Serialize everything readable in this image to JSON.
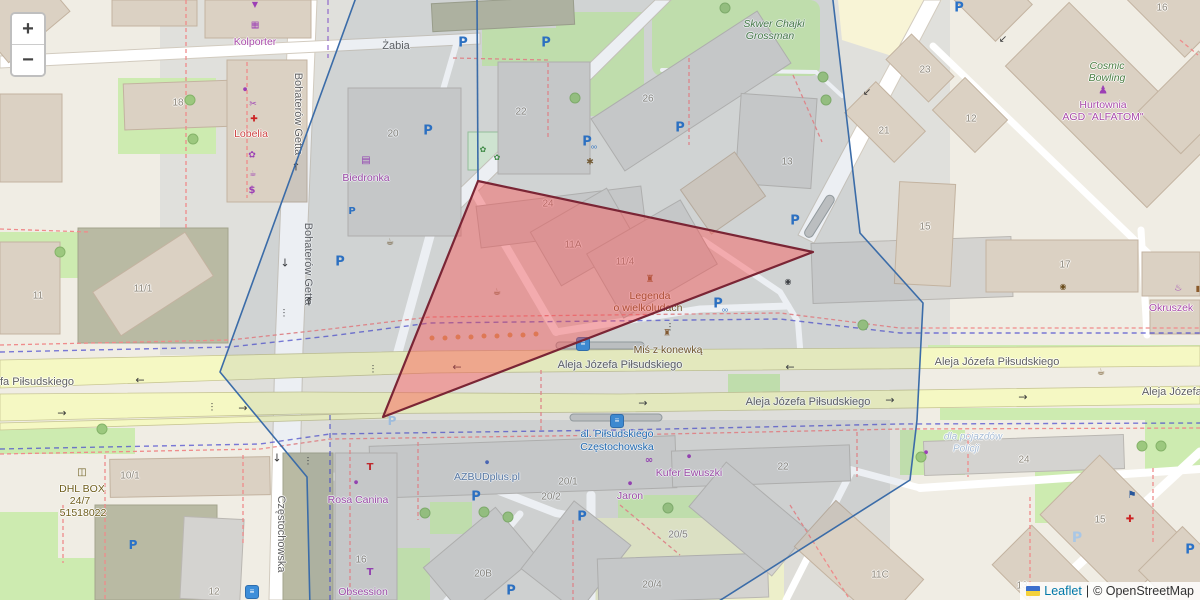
{
  "controls": {
    "zoom_in": "+",
    "zoom_out": "−"
  },
  "attribution": {
    "flag": "ukraine-flag",
    "leaflet_link": "Leaflet",
    "separator": "|",
    "copyright": "© OpenStreetMap"
  },
  "overlays": {
    "red_polygon": {
      "points": "478,181 813,252 383,417",
      "fill": "rgba(255,70,70,0.4)",
      "stroke": "#7a2535"
    },
    "blue_polygon": {
      "points": "358,-8 832,-8 860,233 923,303 917,420 910,480 708,608 310,608 307,477 220,372",
      "fill": "rgba(70,100,140,0.10)",
      "stroke": "#3b6ca8"
    },
    "blue_segment": {
      "points": "477,-5 478,181",
      "stroke": "#3b6ca8"
    }
  },
  "labels": [
    {
      "t": "Żabia",
      "x": 396,
      "y": 46,
      "c": "st"
    },
    {
      "t": "Bohaterów Getta",
      "x": 298,
      "y": 114,
      "c": "st",
      "r": 90
    },
    {
      "t": "Bohaterów Getta",
      "x": 308,
      "y": 264,
      "c": "st",
      "r": 90
    },
    {
      "t": "Częstochowska",
      "x": 281,
      "y": 534,
      "c": "st",
      "r": 90
    },
    {
      "t": "Aleja Józefa Piłsudskiego",
      "x": 620,
      "y": 365,
      "c": "st"
    },
    {
      "t": "Aleja Józefa Piłsudskiego",
      "x": 997,
      "y": 362,
      "c": "st"
    },
    {
      "t": "Aleja Józefa Piłsudskiego",
      "x": 808,
      "y": 402,
      "c": "st"
    },
    {
      "t": "fa Piłsudskiego",
      "x": 37,
      "y": 382,
      "c": "st"
    },
    {
      "t": "Aleja Józefa P",
      "x": 1177,
      "y": 392,
      "c": "st"
    },
    {
      "t": "18",
      "x": 178,
      "y": 103,
      "c": "num"
    },
    {
      "t": "20",
      "x": 393,
      "y": 134,
      "c": "num"
    },
    {
      "t": "22",
      "x": 521,
      "y": 112,
      "c": "num"
    },
    {
      "t": "26",
      "x": 648,
      "y": 99,
      "c": "num"
    },
    {
      "t": "13",
      "x": 787,
      "y": 162,
      "c": "num"
    },
    {
      "t": "23",
      "x": 925,
      "y": 70,
      "c": "num"
    },
    {
      "t": "21",
      "x": 884,
      "y": 131,
      "c": "num"
    },
    {
      "t": "12",
      "x": 971,
      "y": 119,
      "c": "num"
    },
    {
      "t": "16",
      "x": 1162,
      "y": 8,
      "c": "num"
    },
    {
      "t": "11/1",
      "x": 143,
      "y": 289,
      "c": "num"
    },
    {
      "t": "11",
      "x": 38,
      "y": 296,
      "c": "num"
    },
    {
      "t": "11A",
      "x": 573,
      "y": 245,
      "c": "num"
    },
    {
      "t": "11/4",
      "x": 625,
      "y": 262,
      "c": "num"
    },
    {
      "t": "24",
      "x": 548,
      "y": 204,
      "c": "num"
    },
    {
      "t": "15",
      "x": 925,
      "y": 227,
      "c": "num"
    },
    {
      "t": "17",
      "x": 1065,
      "y": 265,
      "c": "num"
    },
    {
      "t": "10/1",
      "x": 130,
      "y": 476,
      "c": "num"
    },
    {
      "t": "12",
      "x": 214,
      "y": 592,
      "c": "num"
    },
    {
      "t": "16",
      "x": 361,
      "y": 560,
      "c": "num"
    },
    {
      "t": "20B",
      "x": 483,
      "y": 574,
      "c": "num"
    },
    {
      "t": "20/1",
      "x": 568,
      "y": 482,
      "c": "num"
    },
    {
      "t": "20/2",
      "x": 551,
      "y": 497,
      "c": "num"
    },
    {
      "t": "20/5",
      "x": 678,
      "y": 535,
      "c": "num"
    },
    {
      "t": "20/4",
      "x": 652,
      "y": 585,
      "c": "num"
    },
    {
      "t": "22",
      "x": 783,
      "y": 467,
      "c": "num"
    },
    {
      "t": "24",
      "x": 1024,
      "y": 460,
      "c": "num"
    },
    {
      "t": "11C",
      "x": 880,
      "y": 575,
      "c": "num"
    },
    {
      "t": "15",
      "x": 1100,
      "y": 520,
      "c": "num"
    },
    {
      "t": "13",
      "x": 1022,
      "y": 586,
      "c": "num"
    },
    {
      "t": "Kolporter",
      "x": 255,
      "y": 42,
      "c": "poi"
    },
    {
      "t": "Biedronka",
      "x": 366,
      "y": 178,
      "c": "poi"
    },
    {
      "t": "Hurtownia",
      "x": 1103,
      "y": 105,
      "c": "poi"
    },
    {
      "t": "AGD \"ALFATOM\"",
      "x": 1103,
      "y": 117,
      "c": "poi"
    },
    {
      "t": "Rosa Canina",
      "x": 358,
      "y": 500,
      "c": "poi"
    },
    {
      "t": "Obsession",
      "x": 363,
      "y": 592,
      "c": "poi"
    },
    {
      "t": "Okruszek",
      "x": 1171,
      "y": 308,
      "c": "poi"
    },
    {
      "t": "Kufer Ewuszki",
      "x": 689,
      "y": 473,
      "c": "poi"
    },
    {
      "t": "Jaron",
      "x": 630,
      "y": 496,
      "c": "poi"
    },
    {
      "t": "Lobelia",
      "x": 251,
      "y": 134,
      "c": "redl"
    },
    {
      "t": "AZBUDplus.pl",
      "x": 487,
      "y": 477,
      "c": "bluegray"
    },
    {
      "t": "Skwer Chajki",
      "x": 774,
      "y": 24,
      "c": "greenl"
    },
    {
      "t": "Grossman",
      "x": 770,
      "y": 36,
      "c": "greenl"
    },
    {
      "t": "Cosmic",
      "x": 1107,
      "y": 66,
      "c": "greenl"
    },
    {
      "t": "Bowling",
      "x": 1107,
      "y": 78,
      "c": "greenl"
    },
    {
      "t": "Legenda",
      "x": 650,
      "y": 296,
      "c": "brownl"
    },
    {
      "t": "o wielkoludach",
      "x": 648,
      "y": 308,
      "c": "brownl"
    },
    {
      "t": "Miś z konewką",
      "x": 668,
      "y": 350,
      "c": "brownl"
    },
    {
      "t": "DHL BOX",
      "x": 82,
      "y": 489,
      "c": "olivel"
    },
    {
      "t": "24/7",
      "x": 80,
      "y": 501,
      "c": "olivel"
    },
    {
      "t": "51518022",
      "x": 83,
      "y": 513,
      "c": "olivel"
    },
    {
      "t": "al. Piłsudskiego",
      "x": 617,
      "y": 434,
      "c": "transit"
    },
    {
      "t": "Częstochowska",
      "x": 617,
      "y": 447,
      "c": "transit"
    },
    {
      "t": "dla pojazdów",
      "x": 973,
      "y": 437,
      "c": "faint"
    },
    {
      "t": "Policji",
      "x": 966,
      "y": 449,
      "c": "faint"
    }
  ],
  "icons": [
    {
      "g": "P",
      "x": 463,
      "y": 43,
      "col": "#2a72c8",
      "s": 13,
      "w": 1,
      "n": "parking-icon"
    },
    {
      "g": "P",
      "x": 546,
      "y": 43,
      "col": "#2a72c8",
      "s": 13,
      "w": 1,
      "n": "parking-icon"
    },
    {
      "g": "P",
      "x": 680,
      "y": 128,
      "col": "#2a72c8",
      "s": 13,
      "w": 1,
      "n": "parking-icon"
    },
    {
      "g": "P",
      "x": 795,
      "y": 221,
      "col": "#2a72c8",
      "s": 13,
      "w": 1,
      "n": "parking-icon"
    },
    {
      "g": "P",
      "x": 718,
      "y": 304,
      "col": "#2a72c8",
      "s": 13,
      "w": 1,
      "n": "parking-icon"
    },
    {
      "g": "P",
      "x": 959,
      "y": 8,
      "col": "#2a72c8",
      "s": 13,
      "w": 1,
      "n": "parking-icon"
    },
    {
      "g": "P",
      "x": 340,
      "y": 262,
      "col": "#2a72c8",
      "s": 13,
      "w": 1,
      "n": "parking-icon"
    },
    {
      "g": "P",
      "x": 428,
      "y": 131,
      "col": "#2a72c8",
      "s": 13,
      "w": 1,
      "n": "parking-icon"
    },
    {
      "g": "P",
      "x": 476,
      "y": 497,
      "col": "#2a72c8",
      "s": 13,
      "w": 1,
      "n": "parking-icon"
    },
    {
      "g": "P",
      "x": 582,
      "y": 517,
      "col": "#2a72c8",
      "s": 13,
      "w": 1,
      "n": "parking-icon"
    },
    {
      "g": "P",
      "x": 511,
      "y": 591,
      "col": "#2a72c8",
      "s": 13,
      "w": 1,
      "n": "parking-icon"
    },
    {
      "g": "P",
      "x": 1190,
      "y": 550,
      "col": "#2a72c8",
      "s": 13,
      "w": 1,
      "n": "parking-icon"
    },
    {
      "g": "P",
      "x": 133,
      "y": 545,
      "col": "#2a72c8",
      "s": 12,
      "w": 1,
      "n": "parking-icon"
    },
    {
      "g": "P",
      "x": 587,
      "y": 142,
      "col": "#2a72c8",
      "s": 13,
      "w": 1,
      "n": "parking-icon"
    },
    {
      "g": "P",
      "x": 352,
      "y": 212,
      "col": "#2a72c8",
      "s": 10,
      "w": 1,
      "n": "parking-icon"
    },
    {
      "g": "P",
      "x": 1077,
      "y": 538,
      "col": "#a9c7e6",
      "s": 14,
      "w": 1,
      "n": "parking-lot-icon"
    },
    {
      "g": "P",
      "x": 392,
      "y": 421,
      "col": "#a9c7e6",
      "s": 12,
      "w": 1,
      "n": "parking-lot-icon"
    },
    {
      "g": "oo",
      "x": 594,
      "y": 148,
      "col": "#2a72c8",
      "s": 5,
      "n": "bicycle-icon"
    },
    {
      "g": "oo",
      "x": 725,
      "y": 311,
      "col": "#2a72c8",
      "s": 5,
      "n": "bicycle-icon"
    },
    {
      "g": "≡",
      "x": 583,
      "y": 344,
      "k": "bus",
      "n": "tram-stop-icon"
    },
    {
      "g": "≡",
      "x": 617,
      "y": 421,
      "k": "bus",
      "n": "tram-stop-icon"
    },
    {
      "g": "≡",
      "x": 252,
      "y": 592,
      "k": "bus",
      "n": "tram-stop-icon"
    },
    {
      "g": "←",
      "x": 457,
      "y": 367,
      "col": "#3a3a3a",
      "s": 11,
      "n": "oneway-arrow-icon"
    },
    {
      "g": "←",
      "x": 790,
      "y": 367,
      "col": "#3a3a3a",
      "s": 11,
      "n": "oneway-arrow-icon"
    },
    {
      "g": "←",
      "x": 140,
      "y": 380,
      "col": "#3a3a3a",
      "s": 11,
      "n": "oneway-arrow-icon"
    },
    {
      "g": "→",
      "x": 643,
      "y": 403,
      "col": "#3a3a3a",
      "s": 11,
      "n": "oneway-arrow-icon"
    },
    {
      "g": "→",
      "x": 243,
      "y": 408,
      "col": "#3a3a3a",
      "s": 11,
      "n": "oneway-arrow-icon"
    },
    {
      "g": "→",
      "x": 62,
      "y": 413,
      "col": "#3a3a3a",
      "s": 11,
      "n": "oneway-arrow-icon"
    },
    {
      "g": "→",
      "x": 1023,
      "y": 397,
      "col": "#3a3a3a",
      "s": 11,
      "n": "oneway-arrow-icon"
    },
    {
      "g": "→",
      "x": 890,
      "y": 400,
      "col": "#3a3a3a",
      "s": 11,
      "n": "oneway-arrow-icon"
    },
    {
      "g": "↓",
      "x": 285,
      "y": 263,
      "col": "#3a3a3a",
      "s": 11,
      "n": "oneway-arrow-icon"
    },
    {
      "g": "↓",
      "x": 277,
      "y": 458,
      "col": "#3a3a3a",
      "s": 11,
      "n": "oneway-arrow-icon"
    },
    {
      "g": "↑",
      "x": 309,
      "y": 302,
      "col": "#3a3a3a",
      "s": 11,
      "n": "oneway-arrow-icon"
    },
    {
      "g": "↑",
      "x": 296,
      "y": 167,
      "col": "#3a3a3a",
      "s": 11,
      "n": "oneway-arrow-icon"
    },
    {
      "g": "↙",
      "x": 867,
      "y": 93,
      "col": "#3a3a3a",
      "s": 10,
      "n": "oneway-arrow-icon"
    },
    {
      "g": "↙",
      "x": 1003,
      "y": 40,
      "col": "#3a3a3a",
      "s": 10,
      "n": "oneway-arrow-icon"
    },
    {
      "g": "⋮",
      "x": 284,
      "y": 314,
      "col": "#333333",
      "s": 9,
      "n": "traffic-signal-icon"
    },
    {
      "g": "⋮",
      "x": 308,
      "y": 462,
      "col": "#333333",
      "s": 9,
      "n": "traffic-signal-icon"
    },
    {
      "g": "⋮",
      "x": 373,
      "y": 370,
      "col": "#333333",
      "s": 9,
      "n": "traffic-signal-icon"
    },
    {
      "g": "⋮",
      "x": 670,
      "y": 328,
      "col": "#333333",
      "s": 9,
      "n": "traffic-signal-icon"
    },
    {
      "g": "⋮",
      "x": 212,
      "y": 408,
      "col": "#333333",
      "s": 9,
      "n": "traffic-signal-icon"
    },
    {
      "g": "▼",
      "x": 255,
      "y": 5,
      "col": "#9c3fb5",
      "s": 8,
      "n": "parcel-locker-icon"
    },
    {
      "g": "▦",
      "x": 255,
      "y": 26,
      "col": "#9c3fb5",
      "s": 9,
      "n": "kiosk-icon"
    },
    {
      "g": "●",
      "x": 245,
      "y": 90,
      "col": "#9c3fb5",
      "s": 5,
      "n": "shop-dot-icon"
    },
    {
      "g": "✂",
      "x": 253,
      "y": 105,
      "col": "#9c3fb5",
      "s": 9,
      "n": "hairdresser-icon"
    },
    {
      "g": "✚",
      "x": 254,
      "y": 120,
      "col": "#cc2222",
      "s": 9,
      "n": "pharmacy-icon"
    },
    {
      "g": "✿",
      "x": 252,
      "y": 156,
      "col": "#9c3fb5",
      "s": 9,
      "n": "florist-icon"
    },
    {
      "g": "☕",
      "x": 253,
      "y": 174,
      "col": "#9c3fb5",
      "s": 8,
      "n": "cafe-icon"
    },
    {
      "g": "$",
      "x": 252,
      "y": 191,
      "col": "#9c3fb5",
      "s": 10,
      "w": 1,
      "n": "money-icon"
    },
    {
      "g": "▤",
      "x": 366,
      "y": 161,
      "col": "#9c3fb5",
      "s": 10,
      "n": "supermarket-icon"
    },
    {
      "g": "✱",
      "x": 590,
      "y": 163,
      "col": "#7a5c2e",
      "s": 9,
      "n": "artwork-icon"
    },
    {
      "g": "☕",
      "x": 390,
      "y": 243,
      "col": "#6b4e1f",
      "s": 9,
      "n": "waste-basket-icon"
    },
    {
      "g": "☕",
      "x": 497,
      "y": 293,
      "col": "#6b4e1f",
      "s": 9,
      "n": "waste-basket-icon"
    },
    {
      "g": "◉",
      "x": 788,
      "y": 282,
      "col": "#3d3d3d",
      "s": 8,
      "n": "camera-icon"
    },
    {
      "g": "◉",
      "x": 1063,
      "y": 287,
      "col": "#6b4e1f",
      "s": 8,
      "n": "viewpoint-icon"
    },
    {
      "g": "☕",
      "x": 1101,
      "y": 373,
      "col": "#6b4e1f",
      "s": 9,
      "n": "waste-basket-icon"
    },
    {
      "g": "♜",
      "x": 650,
      "y": 280,
      "col": "#8a5a2a",
      "s": 10,
      "n": "monument-icon"
    },
    {
      "g": "♜",
      "x": 667,
      "y": 334,
      "col": "#8a5a2a",
      "s": 9,
      "n": "monument-icon"
    },
    {
      "g": "♟",
      "x": 1103,
      "y": 90,
      "col": "#9c3fb5",
      "s": 11,
      "n": "bowling-icon"
    },
    {
      "g": "∞",
      "x": 649,
      "y": 461,
      "col": "#9c3fb5",
      "s": 10,
      "w": 1,
      "n": "optician-icon"
    },
    {
      "g": "●",
      "x": 689,
      "y": 457,
      "col": "#9c3fb5",
      "s": 5,
      "n": "shop-dot-icon"
    },
    {
      "g": "●",
      "x": 630,
      "y": 484,
      "col": "#9c3fb5",
      "s": 5,
      "n": "shop-dot-icon"
    },
    {
      "g": "●",
      "x": 356,
      "y": 483,
      "col": "#9c3fb5",
      "s": 5,
      "n": "shop-dot-icon"
    },
    {
      "g": "●",
      "x": 487,
      "y": 463,
      "col": "#4a66b8",
      "s": 5,
      "n": "office-dot-icon"
    },
    {
      "g": "●",
      "x": 926,
      "y": 453,
      "col": "#9c3fb5",
      "s": 5,
      "n": "shop-dot-icon"
    },
    {
      "g": "T",
      "x": 370,
      "y": 468,
      "col": "#cc2222",
      "s": 10,
      "w": 1,
      "n": "clothes-icon"
    },
    {
      "g": "T",
      "x": 370,
      "y": 573,
      "col": "#9c3fb5",
      "s": 10,
      "w": 1,
      "n": "clothes-icon"
    },
    {
      "g": "♨",
      "x": 1178,
      "y": 289,
      "col": "#9c3fb5",
      "s": 9,
      "n": "bakery-icon"
    },
    {
      "g": "▮",
      "x": 1198,
      "y": 289,
      "col": "#8a5a2a",
      "s": 8,
      "n": "poi-icon"
    },
    {
      "g": "◫",
      "x": 82,
      "y": 473,
      "col": "#6b5d1e",
      "s": 10,
      "n": "parcel-box-icon"
    },
    {
      "g": "✚",
      "x": 1130,
      "y": 520,
      "col": "#cc2222",
      "s": 10,
      "n": "clinic-icon"
    },
    {
      "g": "⚑",
      "x": 1132,
      "y": 496,
      "col": "#27569b",
      "s": 10,
      "n": "flag-icon"
    },
    {
      "g": "✿",
      "x": 483,
      "y": 150,
      "col": "#3f8f3f",
      "s": 8,
      "n": "playground-icon"
    },
    {
      "g": "✿",
      "x": 497,
      "y": 158,
      "col": "#3f8f3f",
      "s": 8,
      "n": "playground-icon"
    }
  ],
  "trees": [
    [
      190,
      100
    ],
    [
      193,
      139
    ],
    [
      575,
      98
    ],
    [
      725,
      8
    ],
    [
      823,
      77
    ],
    [
      826,
      100
    ],
    [
      863,
      325
    ],
    [
      1142,
      446
    ],
    [
      1161,
      446
    ],
    [
      425,
      513
    ],
    [
      484,
      512
    ],
    [
      508,
      517
    ],
    [
      668,
      508
    ],
    [
      60,
      252
    ],
    [
      102,
      429
    ],
    [
      921,
      457
    ]
  ],
  "bollards": [
    [
      432,
      338
    ],
    [
      445,
      338
    ],
    [
      458,
      337
    ],
    [
      471,
      337
    ],
    [
      484,
      336
    ],
    [
      497,
      336
    ],
    [
      510,
      335
    ],
    [
      523,
      335
    ],
    [
      536,
      334
    ]
  ]
}
